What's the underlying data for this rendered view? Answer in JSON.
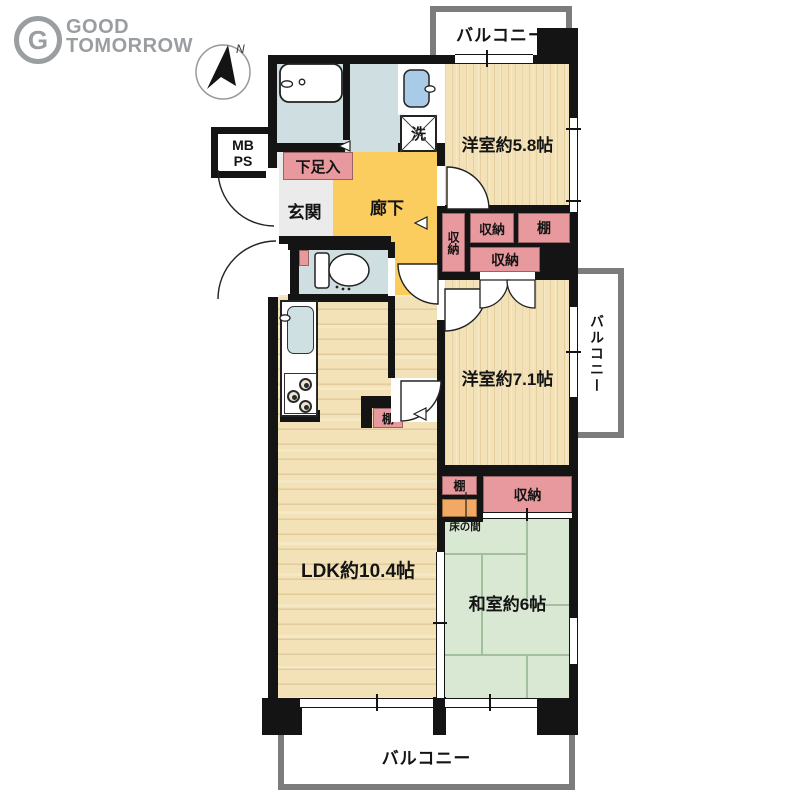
{
  "brand": {
    "line1": "GOOD",
    "line2": "TOMORROW",
    "icon_letter": "G"
  },
  "compass": {
    "north_label": "N"
  },
  "floorplan": {
    "balconies": {
      "top": "バルコニー",
      "right": "バルコニー",
      "bottom": "バルコニー"
    },
    "rooms": {
      "western_58": "洋室約5.8帖",
      "western_71": "洋室約7.1帖",
      "ldk": "LDK約10.4帖",
      "japanese_6": "和室約6帖",
      "entrance": "玄関",
      "hallway": "廊下"
    },
    "features": {
      "shoe_cabinet": "下足入",
      "meter_box": "MB",
      "pipe_space": "PS",
      "laundry": "洗",
      "closet_hall_vertical": "収納",
      "closet_58_left": "収納",
      "shelf_58": "棚",
      "closet_58_lower": "収納",
      "shelf_ldk": "棚",
      "shelf_washitsu": "棚",
      "closet_washitsu": "収納",
      "tokonoma": "床の間"
    }
  },
  "colors": {
    "wall": "#141414",
    "wood": "#f3e2b7",
    "tatami": "#d8e8d2",
    "closet_pink": "#e8999e",
    "hallway_yellow": "#fbcd5e",
    "water_blue": "#cfdfe1",
    "fixture_blue": "#a9cbe8",
    "tokonoma_orange": "#f2a963",
    "balcony_gray": "#7c7c7c",
    "brand_gray": "#9b9ea1"
  }
}
